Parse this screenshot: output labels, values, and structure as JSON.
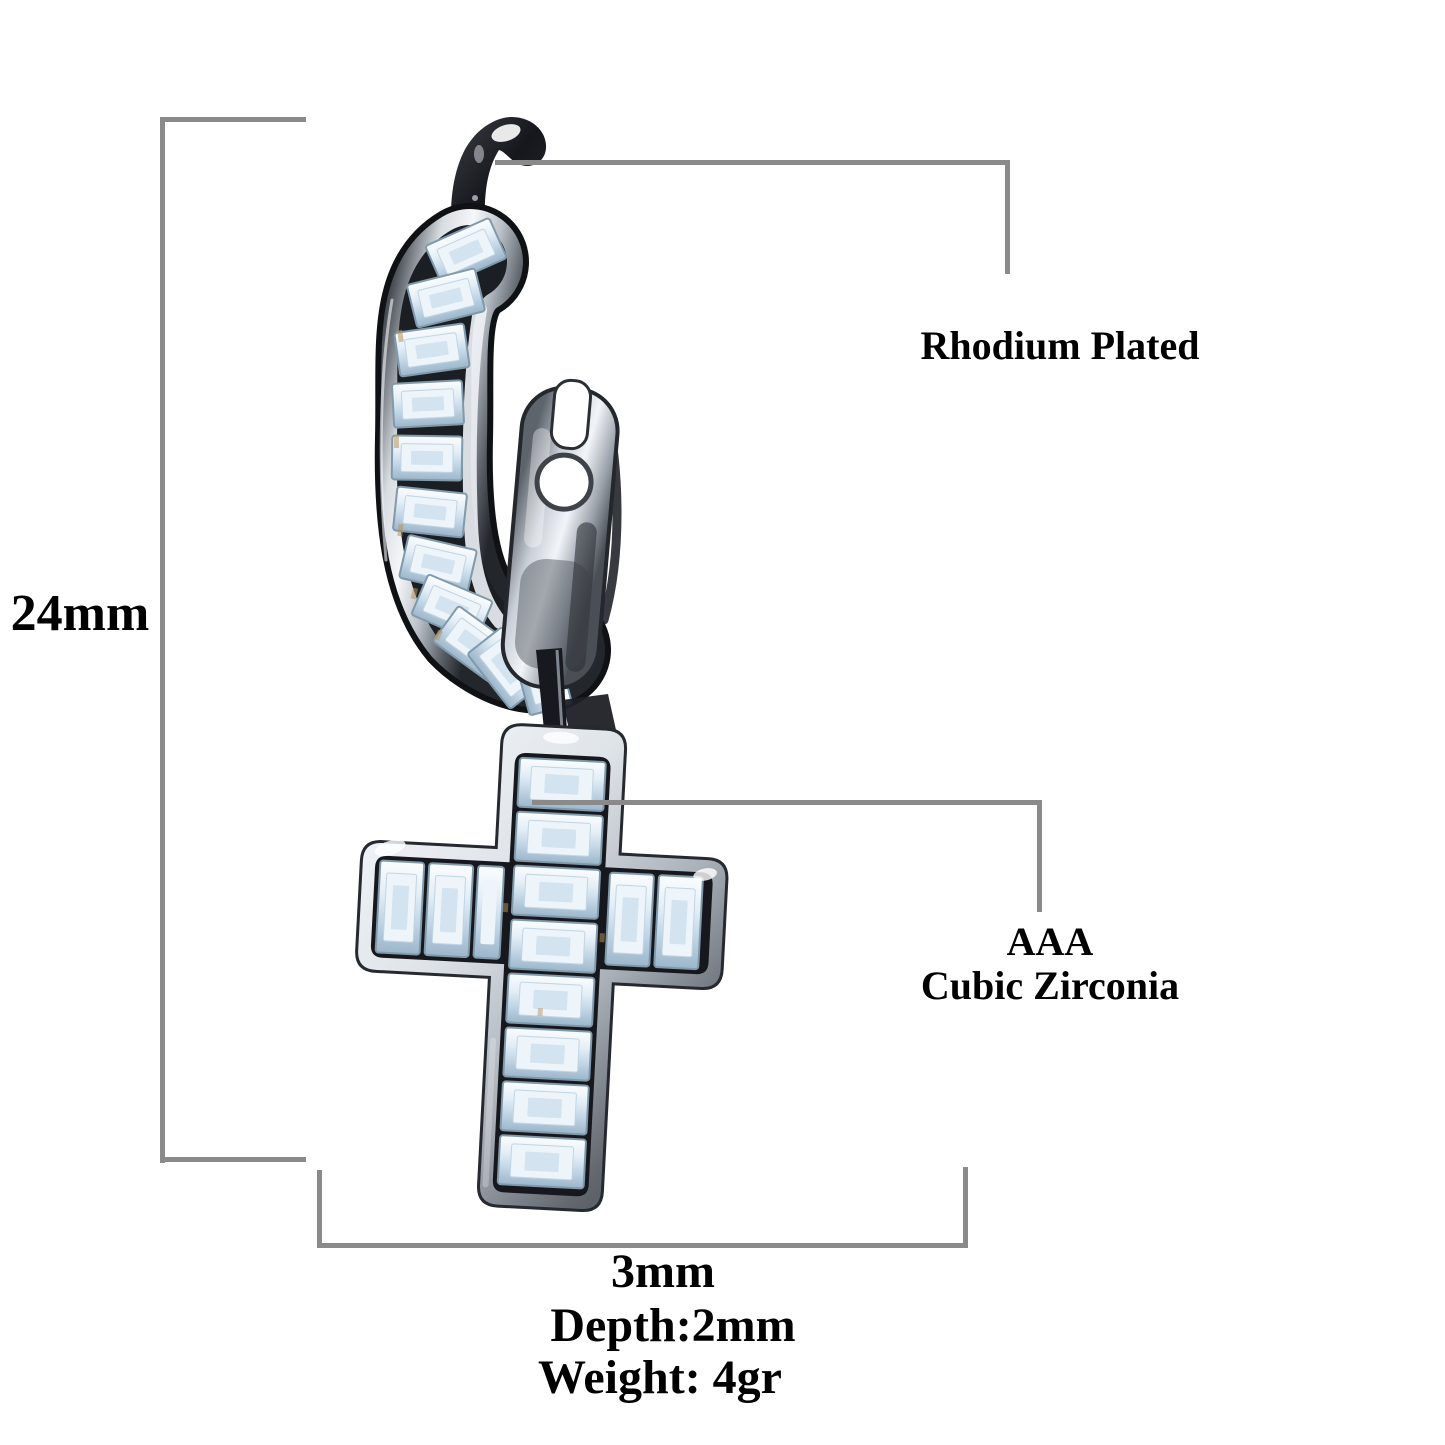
{
  "colors": {
    "background": "#ffffff",
    "annotation_line": "#8a8a8a",
    "label_text": "#000000",
    "metal_dark": "#15171c",
    "metal_silver": "#e9edf2",
    "stone_blue": "#dbe9f4",
    "gold_fleck": "#b5955e"
  },
  "annotations": {
    "height": {
      "label": "24mm"
    },
    "width": {
      "label": "3mm"
    },
    "depth": {
      "label": "Depth:2mm"
    },
    "weight": {
      "label": "Weight: 4gr"
    },
    "plating": {
      "label": "Rhodium Plated"
    },
    "stone": {
      "line1": "AAA",
      "line2": "Cubic Zirconia"
    }
  },
  "product_image": {
    "name": "cz-baguette-cross-dangle-hoop-earring",
    "description": "Rhodium plated hoop earring with channel-set baguette cubic zirconia and dangling cross pendant"
  }
}
